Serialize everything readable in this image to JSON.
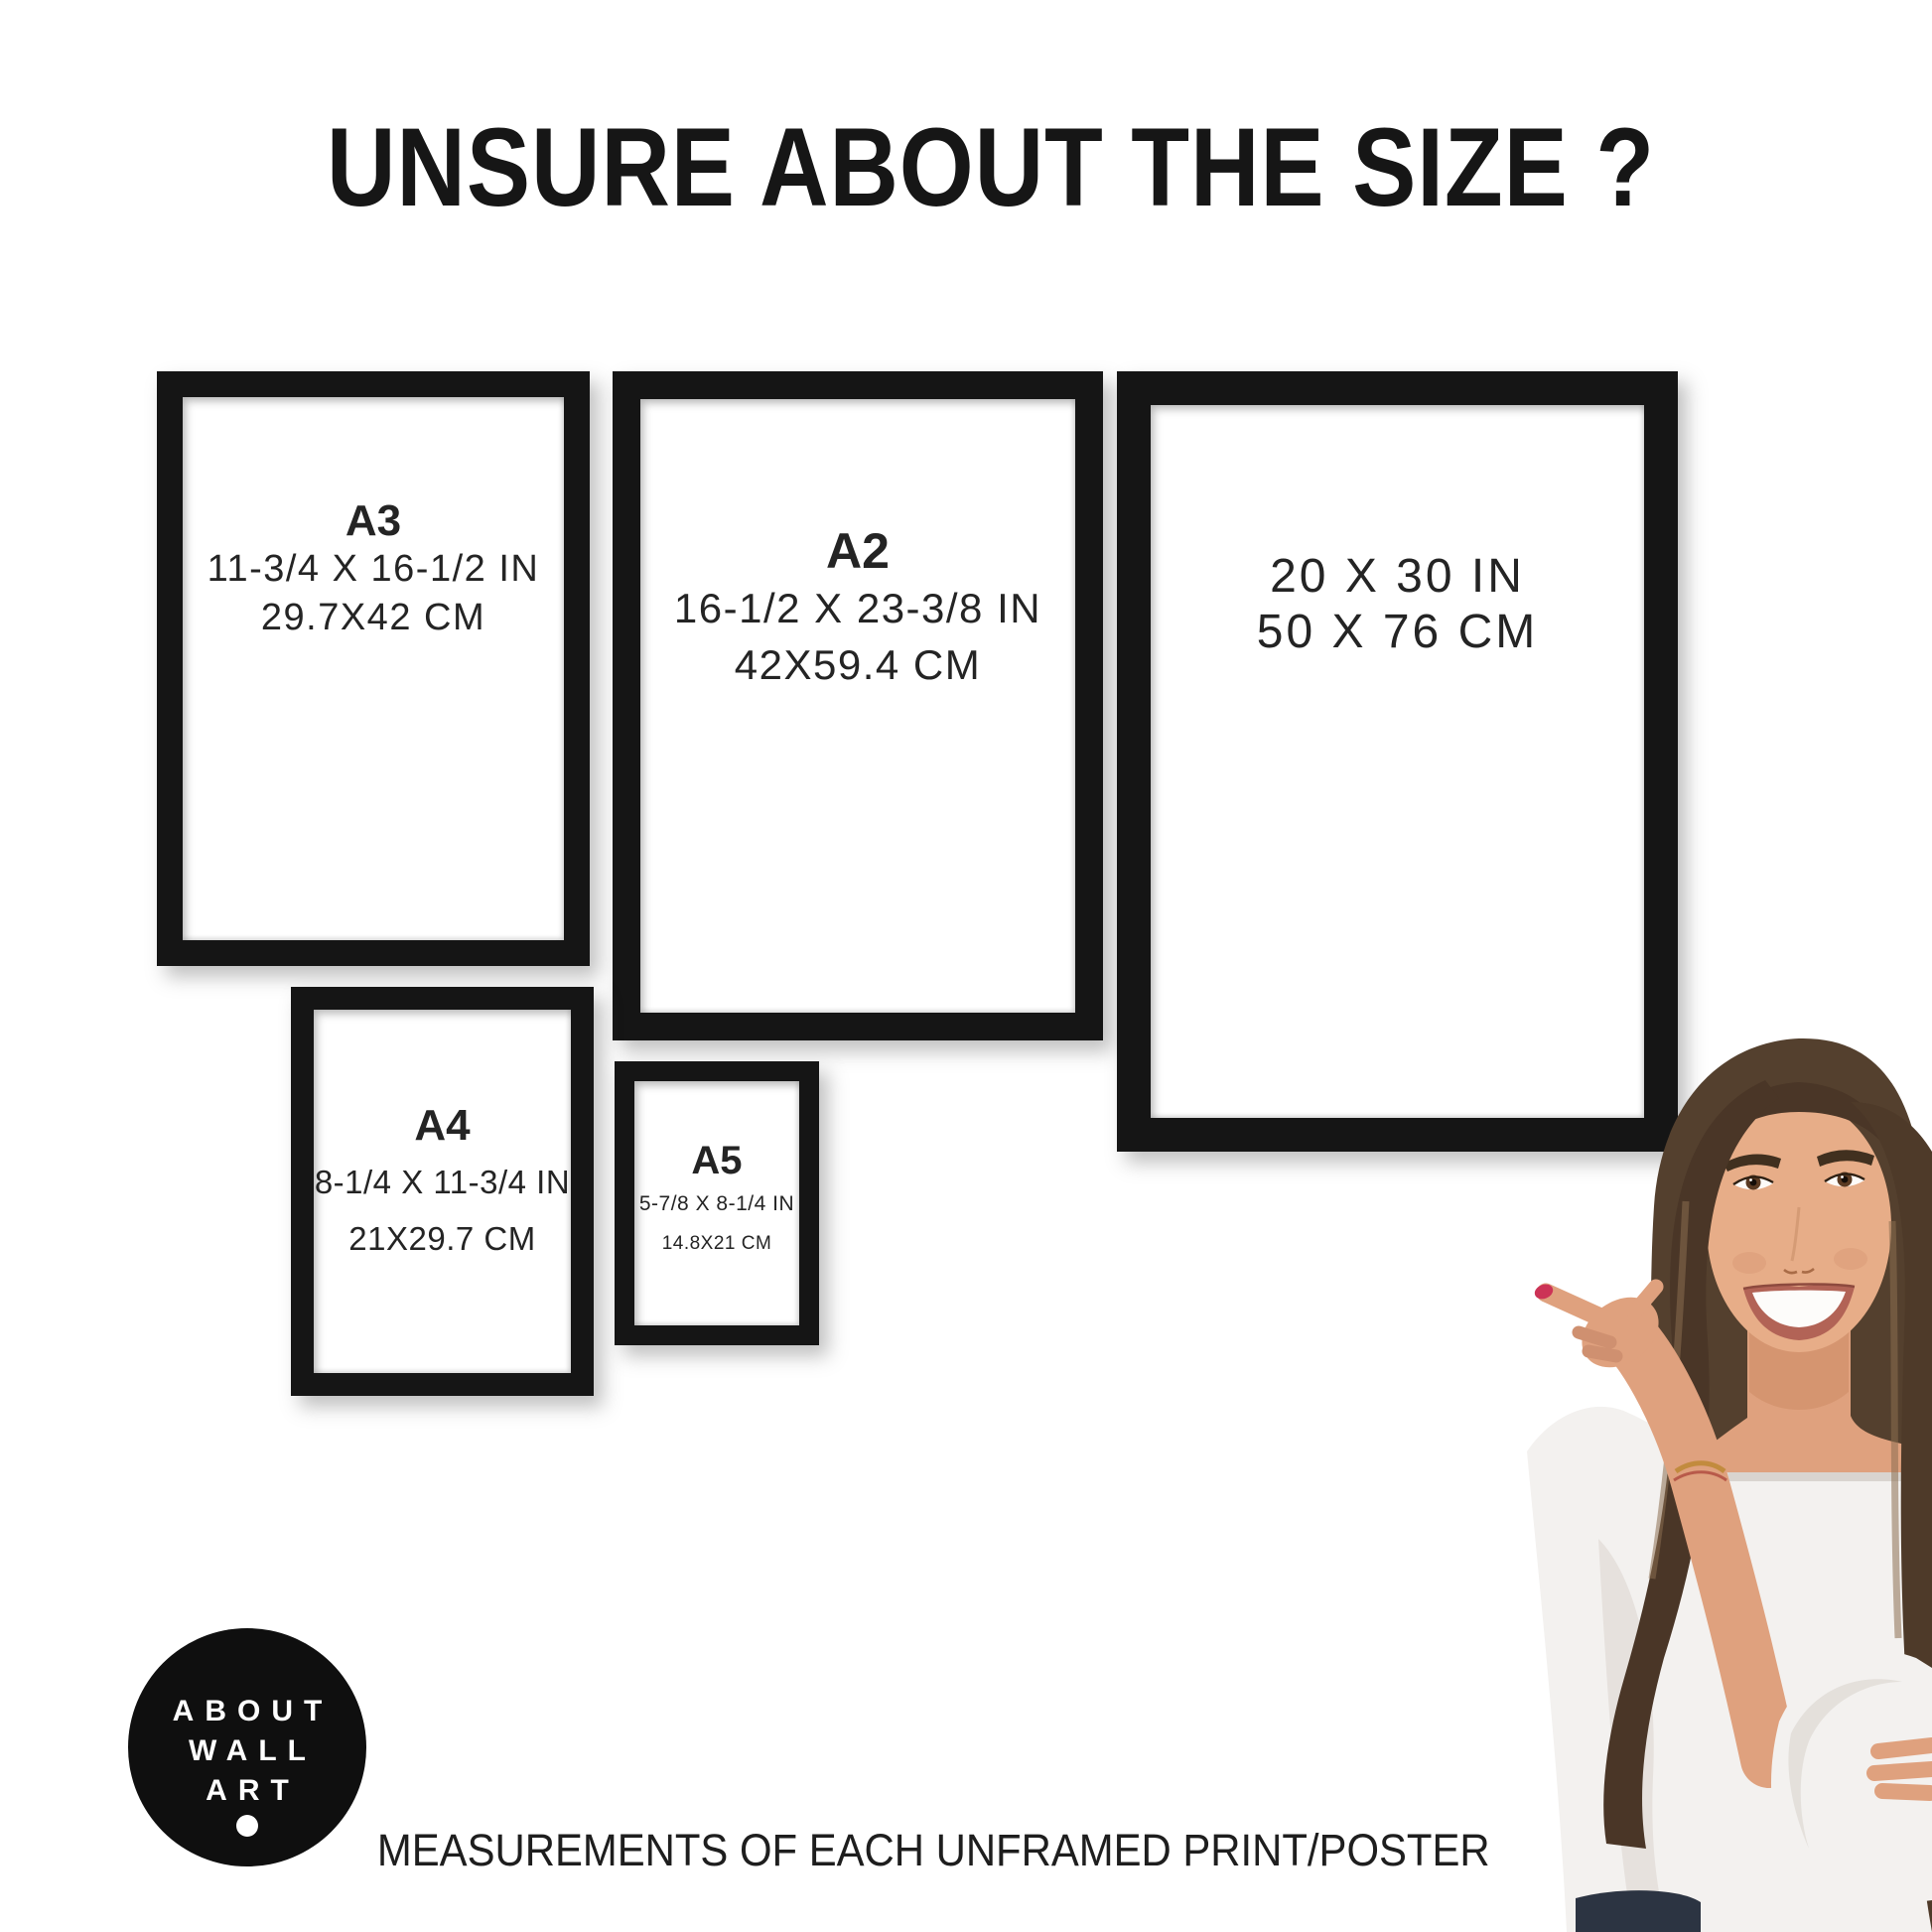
{
  "title": "UNSURE ABOUT THE SIZE ?",
  "frames": [
    {
      "id": "a3",
      "label": "A3",
      "inches": "11-3/4 X 16-1/2 IN",
      "cm": "29.7X42 CM"
    },
    {
      "id": "a2",
      "label": "A2",
      "inches": "16-1/2 X 23-3/8 IN",
      "cm": "42X59.4 CM"
    },
    {
      "id": "20x30",
      "label": "",
      "inches": "20 X 30 IN",
      "cm": "50 X 76 CM"
    },
    {
      "id": "a4",
      "label": "A4",
      "inches": "8-1/4 X 11-3/4 IN",
      "cm": "21X29.7 CM"
    },
    {
      "id": "a5",
      "label": "A5",
      "inches": "5-7/8 X 8-1/4 IN",
      "cm": "14.8X21 CM"
    }
  ],
  "logo": {
    "lines": [
      "ABOUT",
      "WALL",
      "ART"
    ]
  },
  "footer": "MEASUREMENTS OF EACH UNFRAMED PRINT/POSTER",
  "colors": {
    "frame_border": "#151515",
    "text": "#1c1c1c",
    "logo_background": "#0f0f0f",
    "logo_text": "#ffffff",
    "skin": "#dfa17e",
    "hair": "#54402e",
    "blouse": "#f3f1ef",
    "nail_polish": "#cc3356",
    "jeans": "#2c3442"
  }
}
